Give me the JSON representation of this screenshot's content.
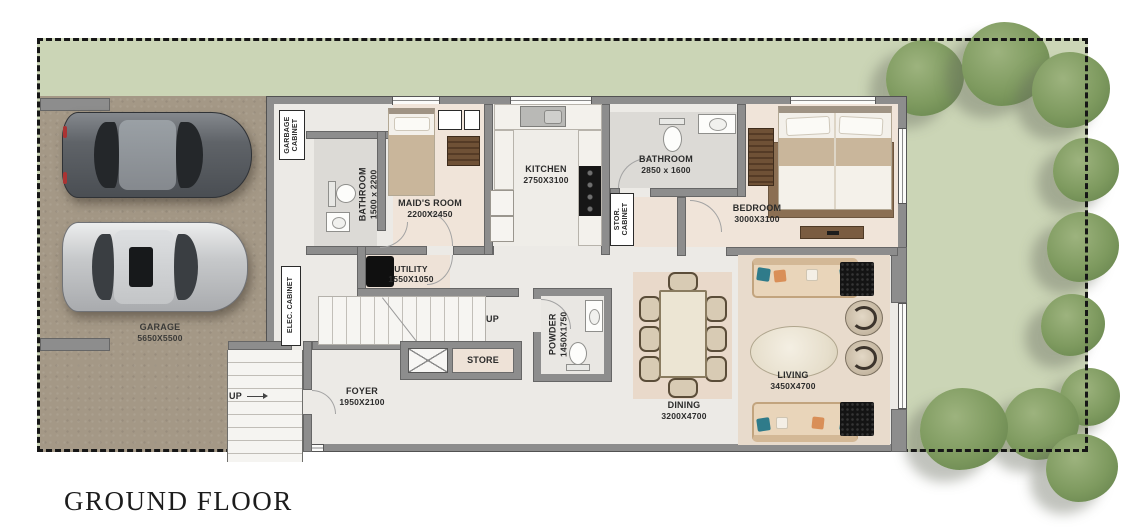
{
  "title": "GROUND FLOOR",
  "rooms": {
    "garage": {
      "name": "GARAGE",
      "dims": "5650X5500"
    },
    "garbage_cabinet": {
      "line1": "GARBAGE",
      "line2": "CABINET"
    },
    "maids_bathroom": {
      "name": "BATHROOM",
      "dims": "1500 x 2200"
    },
    "maids_room": {
      "name": "MAID'S ROOM",
      "dims": "2200X2450"
    },
    "kitchen": {
      "name": "KITCHEN",
      "dims": "2750X3100"
    },
    "bathroom": {
      "name": "BATHROOM",
      "dims": "2850 x 1600"
    },
    "stor_cabinet": {
      "line1": "STOR.",
      "line2": "CABINET"
    },
    "bedroom": {
      "name": "BEDROOM",
      "dims": "3000X3100"
    },
    "elec_cabinet": {
      "name": "ELEC. CABINET"
    },
    "utility": {
      "name": "UTILITY",
      "dims": "1550X1050"
    },
    "powder": {
      "name": "POWDER",
      "dims": "1450X1750"
    },
    "store": {
      "name": "STORE"
    },
    "foyer": {
      "name": "FOYER",
      "dims": "1950X2100"
    },
    "dining": {
      "name": "DINING",
      "dims": "3200X4700"
    },
    "living": {
      "name": "LIVING",
      "dims": "3450X4700"
    }
  },
  "stairs": {
    "up_label": "UP"
  },
  "entry": {
    "up_label": "UP"
  },
  "colors": {
    "site_green": "#cbd5b6",
    "garage_floor": "#a49886",
    "wall": "#8d8d8d",
    "interior_floor": "#eceae6",
    "room_beige": "#f0e4d9",
    "tree_green": "#7e9a5f",
    "sofa_tan": "#e9d5ba",
    "accent_teal": "#2f7b8a",
    "accent_orange": "#d98f58"
  }
}
